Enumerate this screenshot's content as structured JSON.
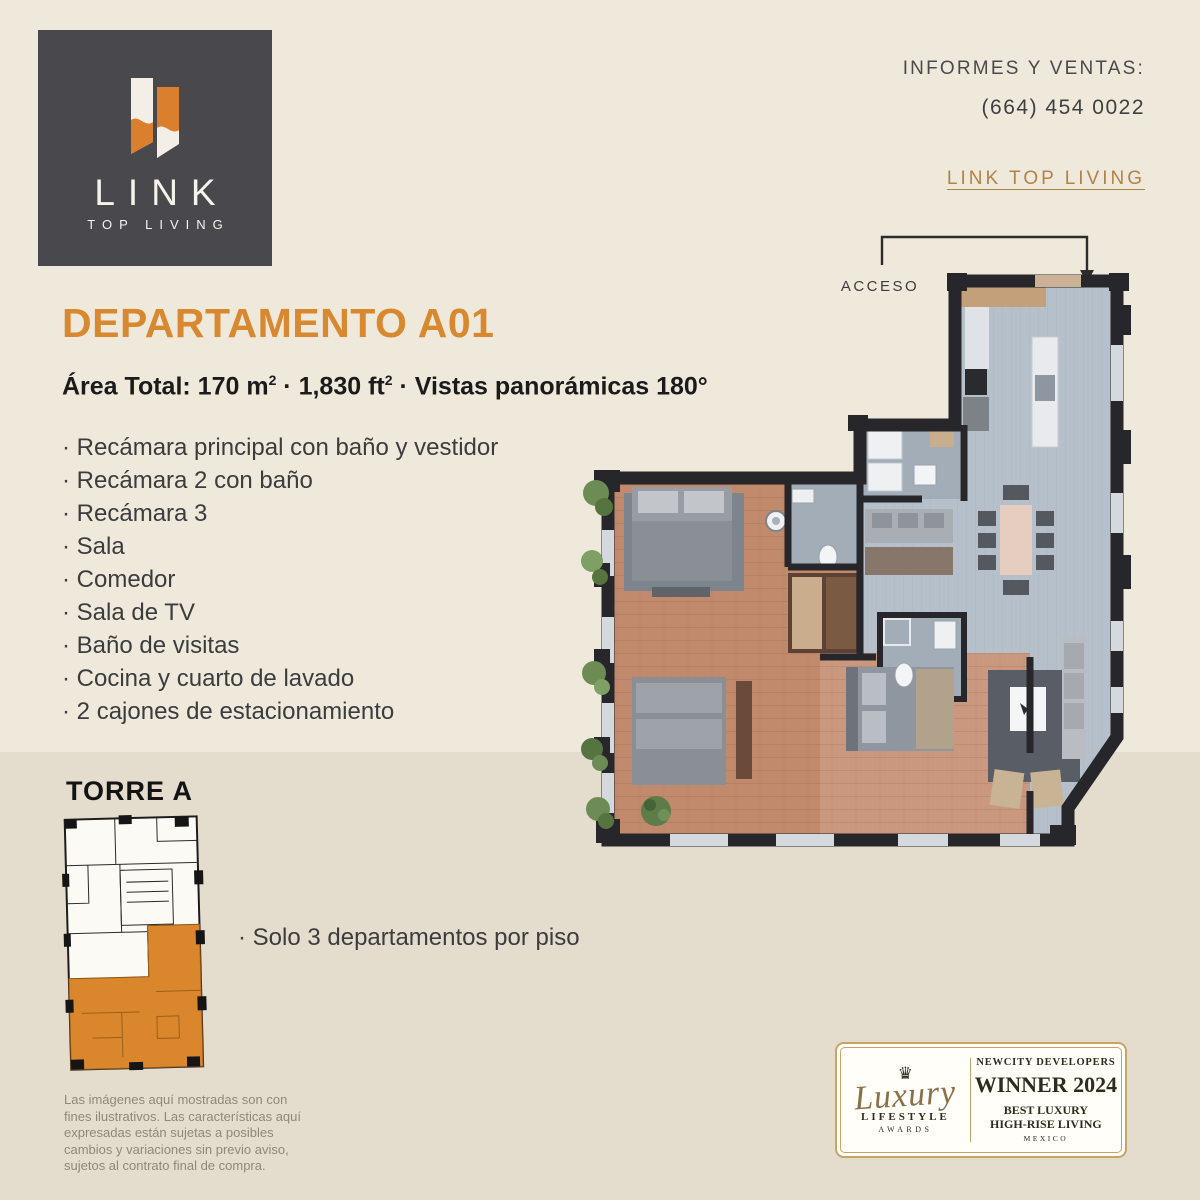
{
  "page": {
    "bg_top": "#efe9dc",
    "bg_bottom": "#e4ddcd"
  },
  "logo": {
    "brand": "LINK",
    "tagline": "TOP LIVING",
    "bg": "#48484d",
    "orange": "#d97f2e"
  },
  "contact": {
    "heading": "INFORMES Y VENTAS:",
    "phone": "(664)  454 0022",
    "link": "LINK TOP LIVING"
  },
  "unit": {
    "title": "DEPARTAMENTO A01",
    "area_p1": "Área Total: 170 m",
    "area_sup1": "2",
    "area_p2": " · 1,830 ft",
    "area_sup2": "2",
    "area_p3": "  · Vistas panorámicas 180°"
  },
  "features": {
    "items": [
      "Recámara principal con baño y vestidor",
      "Recámara 2 con baño",
      "Recámara 3",
      "Sala",
      "Comedor",
      "Sala de TV",
      "Baño de visitas",
      "Cocina y cuarto de lavado",
      "2 cajones de estacionamiento"
    ]
  },
  "plan": {
    "acceso_label": "ACCESO"
  },
  "torre": {
    "title": "TORRE A",
    "note": "Solo 3 departamentos por piso",
    "highlight_color": "#d9862c"
  },
  "legal": {
    "text": "Las imágenes aquí mostradas son con fines ilustrativos. Las características aquí expresadas están sujetas a posibles cambios y variaciones sin previo aviso, sujetos al contrato final de compra."
  },
  "award": {
    "crown_icon": "♛",
    "script": "Luxury",
    "lifestyle": "LIFESTYLE",
    "awards": "AWARDS",
    "company": "NEWCITY DEVELOPERS",
    "winner": "WINNER 2024",
    "category1": "BEST LUXURY",
    "category2": "HIGH-RISE LIVING",
    "country": "MEXICO",
    "gold": "#c3a566"
  },
  "colors": {
    "accent_orange": "#d8882f",
    "link_gold": "#b28347",
    "wall": "#26262b",
    "tile_floor": "#b6c0ca",
    "wood_floor": "#c28a6c"
  }
}
